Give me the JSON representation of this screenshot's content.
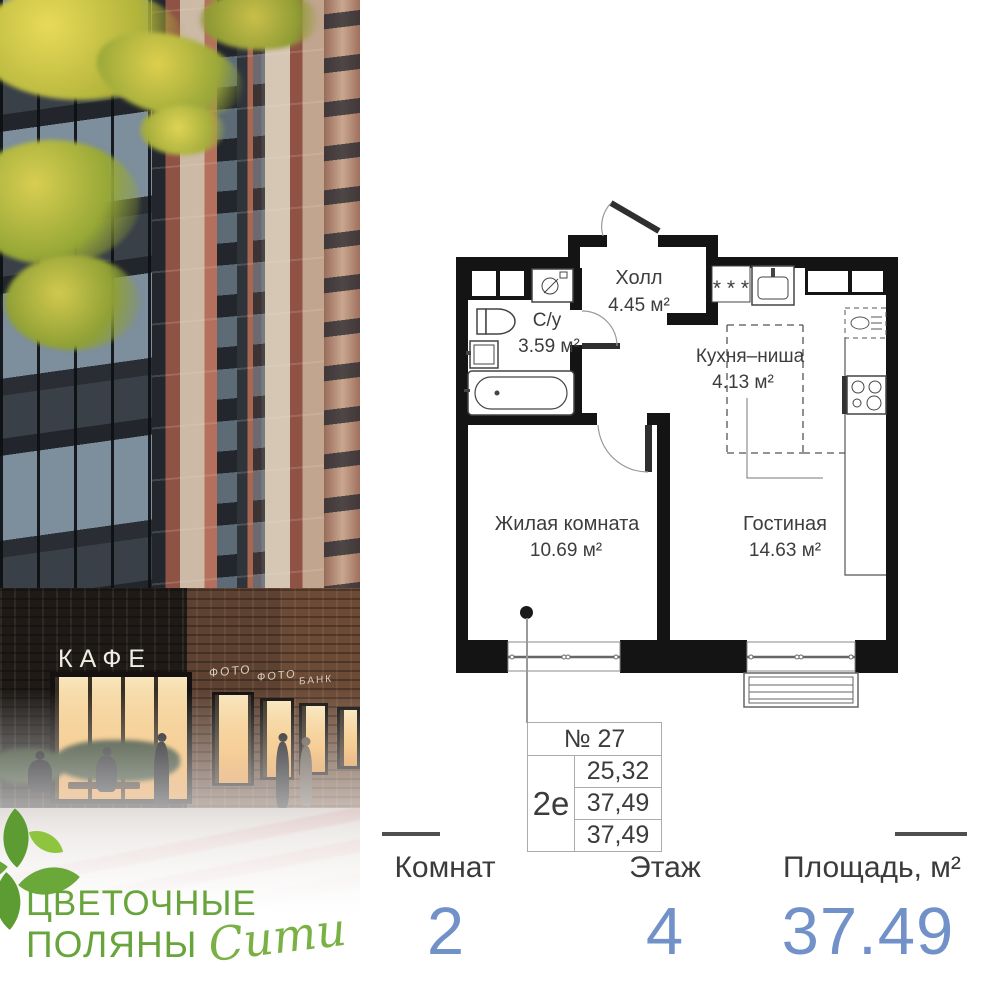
{
  "brand": {
    "line1": "ЦВЕТОЧНЫЕ",
    "line2": "ПОЛЯНЫ",
    "script": "Сити"
  },
  "photo": {
    "cafe_sign": "КАФЕ",
    "shop_signs": [
      "ФОТО",
      "ФОТО",
      "БАНК"
    ]
  },
  "plan": {
    "vent_symbol": "* * *",
    "rooms": [
      {
        "name": "Холл",
        "area": "4.45 м²"
      },
      {
        "name": "С/у",
        "area": "3.59 м²"
      },
      {
        "name": "Кухня–ниша",
        "area": "4.13 м²"
      },
      {
        "name": "Жилая комната",
        "area": "10.69 м²"
      },
      {
        "name": "Гостиная",
        "area": "14.63 м²"
      }
    ]
  },
  "info_table": {
    "number": "№ 27",
    "type": "2е",
    "values": [
      "25,32",
      "37,49",
      "37,49"
    ]
  },
  "stats": [
    {
      "label": "Комнат",
      "value": "2"
    },
    {
      "label": "Этаж",
      "value": "4"
    },
    {
      "label": "Площадь, м²",
      "value": "37.49"
    }
  ],
  "colors": {
    "accent_blue": "#7191c8",
    "brand_green": "#68a43c",
    "wall": "#141414"
  }
}
